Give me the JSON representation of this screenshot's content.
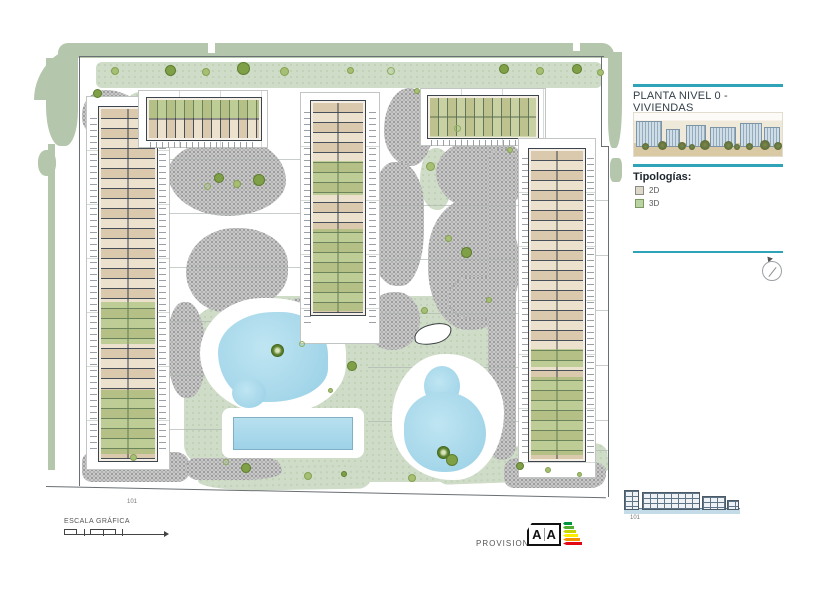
{
  "panel": {
    "title": "PLANTA NIVEL 0 - VIVIENDAS",
    "legend_title": "Tipologías:",
    "legend": [
      {
        "label": "2D"
      },
      {
        "label": "3D"
      }
    ]
  },
  "annotations": {
    "scale_label": "ESCALA GRÁFICA",
    "provisional_label": "PROVISIONAL",
    "energy_letter_left": "A",
    "energy_letter_right": "A",
    "plan_marker": "101",
    "elevation_marker": "101"
  },
  "icons": {
    "north_arrow": "north-arrow-icon",
    "energy_rating": "energy-rating-icon"
  },
  "colors": {
    "accent-teal": "#2fa3b7",
    "legend-2d": "#ded8c9",
    "legend-3d": "#b9d3a3",
    "pool-blue": "#a6d7e8",
    "lawn-green": "#cfdcc8",
    "band-green": "#b4c6ab",
    "paving-gray": "#c8c8c8",
    "unit-beige": "#dbc9ae",
    "unit-green": "#c2d8ab",
    "ink": "#39424a"
  }
}
